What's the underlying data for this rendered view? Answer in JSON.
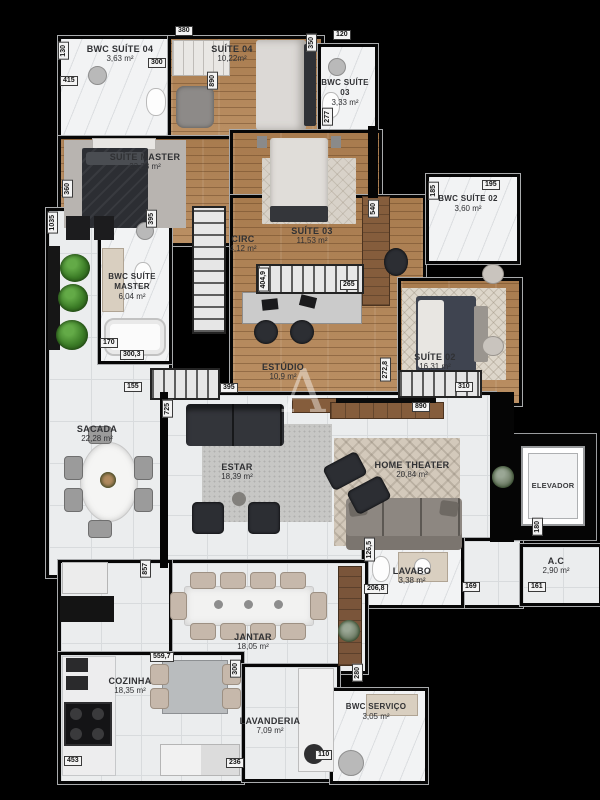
{
  "watermark": "A",
  "rooms": {
    "bwc_suite_04": {
      "name": "BWC SUÍTE 04",
      "area": "3,63 m²"
    },
    "suite_04": {
      "name": "SUÍTE 04",
      "area": "10,22m²"
    },
    "bwc_suite_03": {
      "name": "BWC SUÍTE 03",
      "area": "3,33 m²"
    },
    "suite_master": {
      "name": "SUÍTE MASTER",
      "area": "23,23 m²"
    },
    "circ": {
      "name": "CIRC",
      "area": "4,12 m²"
    },
    "suite_03": {
      "name": "SUÍTE 03",
      "area": "11,53 m²"
    },
    "bwc_suite_02": {
      "name": "BWC SUÍTE 02",
      "area": "3,60 m²"
    },
    "bwc_suite_master": {
      "name": "BWC SUÍTE MASTER",
      "area": "6,04 m²"
    },
    "suite_02": {
      "name": "SUÍTE 02",
      "area": "16,31 m²"
    },
    "estudio": {
      "name": "ESTÚDIO",
      "area": "10,9 m²"
    },
    "sacada": {
      "name": "SACADA",
      "area": "22,28 m²"
    },
    "estar": {
      "name": "ESTAR",
      "area": "18,39 m²"
    },
    "home_theater": {
      "name": "HOME THEATER",
      "area": "20,84 m²"
    },
    "elevador": {
      "name": "ELEVADOR"
    },
    "lavabo": {
      "name": "LAVABO",
      "area": "3,38 m²"
    },
    "ac": {
      "name": "A.C",
      "area": "2,90 m²"
    },
    "jantar": {
      "name": "JANTAR",
      "area": "18,05 m²"
    },
    "cozinha": {
      "name": "COZINHA",
      "area": "18,35 m²"
    },
    "lavanderia": {
      "name": "LAVANDERIA",
      "area": "7,09 m²"
    },
    "bwc_servico": {
      "name": "BWC SERVIÇO",
      "area": "3,05 m²"
    }
  },
  "dims": [
    "130",
    "380",
    "300",
    "890",
    "120",
    "350",
    "415",
    "277",
    "360",
    "195",
    "185",
    "540",
    "1035",
    "395",
    "404,9",
    "265",
    "170",
    "300,3",
    "155",
    "395",
    "272,8",
    "310",
    "890",
    "725",
    "180",
    "126,5",
    "206,8",
    "169",
    "161",
    "857",
    "559,7",
    "300",
    "280",
    "110",
    "236",
    "453"
  ],
  "colors": {
    "background": "#000000",
    "wood_floor": "#b2865a",
    "tile_floor": "#ebedee",
    "marble": "#f2f3f4",
    "plant_green": "#3c7d27",
    "dark_furniture": "#2c2e33",
    "wood_furniture": "#7a553a"
  }
}
